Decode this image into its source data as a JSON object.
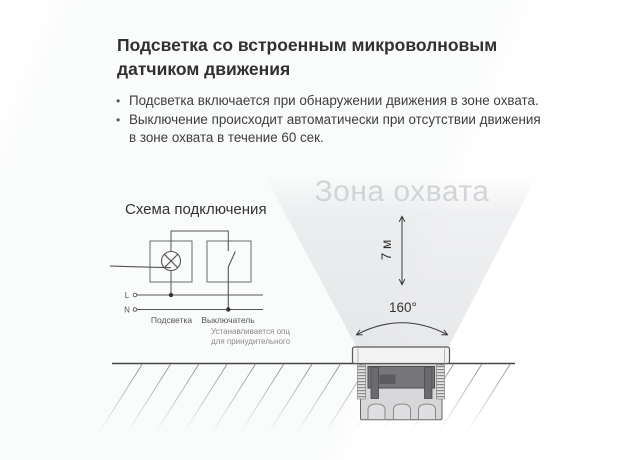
{
  "header": {
    "title_line1": "Подсветка со встроенным микроволновым",
    "title_line2": "датчиком движения"
  },
  "features": {
    "bullet": "•",
    "items": [
      {
        "lines": [
          "Подсветка включается при обнаружении движения в зоне охвата."
        ]
      },
      {
        "lines": [
          "Выключение происходит автоматически при отсутствии движения",
          "в зоне охвата в течение 60 сек."
        ]
      }
    ]
  },
  "wiring": {
    "title": "Схема подключения",
    "line_l_label": "L",
    "line_n_label": "N",
    "lamp_label": "Подсветка",
    "switch_label": "Выключатель",
    "switch_note_line1": "Устанавливается опционально",
    "switch_note_line2": "для принудительного выключения."
  },
  "coverage": {
    "zone_title": "Зона охвата",
    "height_label": "7 м",
    "angle_label": "160°"
  },
  "colors": {
    "text_primary": "#303030",
    "text_secondary": "#555555",
    "note_text": "#8a8a8a",
    "zone_title_gray": "#d2d4d7",
    "cone_tint": "#d6d8dc",
    "diagram_stroke": "#555555",
    "ground_stroke": "#454545"
  }
}
